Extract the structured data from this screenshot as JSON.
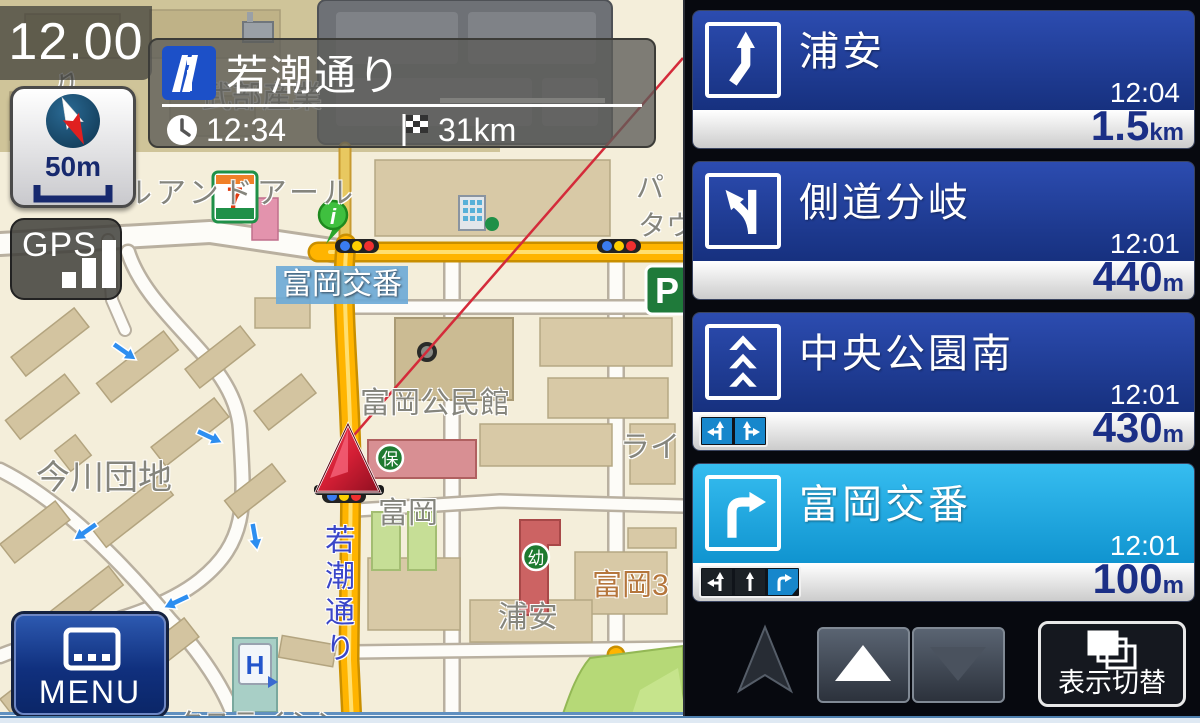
{
  "colors": {
    "card_blue": "#1c3a92",
    "card_highlight": "#14a0dc",
    "distance_navy": "#1b2f86",
    "lane_blue": "#1787cc",
    "map_bg": "#f4eeda",
    "yellow_road": "#ffb400",
    "route_red": "#d42b3a"
  },
  "map": {
    "clock": "12.00",
    "compass": {
      "scale": "50m"
    },
    "gps": "GPS",
    "banner": {
      "road": "若潮通り",
      "eta": "12:34",
      "distance": "31km"
    },
    "menu": "MENU",
    "labels": {
      "yonku": "ヨンク",
      "takebe": "武部産業",
      "ru_ando": "ルアンドアール",
      "pa": "パ",
      "tau": "タウ",
      "koban": "富岡交番",
      "kominkan": "富岡公民館",
      "imagawa": "今川団地",
      "tomioka": "富岡",
      "rai": "ライ",
      "urayasu": "浦安",
      "tomioka3": "富岡3",
      "wakashio_vert": "若潮通り",
      "bottom_cut": "ックスライシン"
    },
    "poi": {
      "info": "i",
      "seven": "7",
      "parking": "P",
      "nursery": "保",
      "kindergarten": "幼",
      "hotel": "H"
    }
  },
  "panel": {
    "cards": [
      {
        "title": "浦安",
        "time": "12:04",
        "dist": "1.5",
        "unit": "km",
        "icon": "slight-right",
        "highlight": false,
        "lanes": []
      },
      {
        "title": "側道分岐",
        "time": "12:01",
        "dist": "440",
        "unit": "m",
        "icon": "fork-left",
        "highlight": false,
        "lanes": []
      },
      {
        "title": "中央公園南",
        "time": "12:01",
        "dist": "430",
        "unit": "m",
        "icon": "straight-triple",
        "highlight": false,
        "lanes": [
          {
            "type": "straight-left",
            "active": true
          },
          {
            "type": "straight-right",
            "active": true
          }
        ]
      },
      {
        "title": "富岡交番",
        "time": "12:01",
        "dist": "100",
        "unit": "m",
        "icon": "turn-right",
        "highlight": true,
        "lanes": [
          {
            "type": "straight-left",
            "active": false
          },
          {
            "type": "straight",
            "active": false
          },
          {
            "type": "right",
            "active": true
          }
        ]
      }
    ],
    "controls": {
      "toggle_label": "表示切替"
    }
  }
}
